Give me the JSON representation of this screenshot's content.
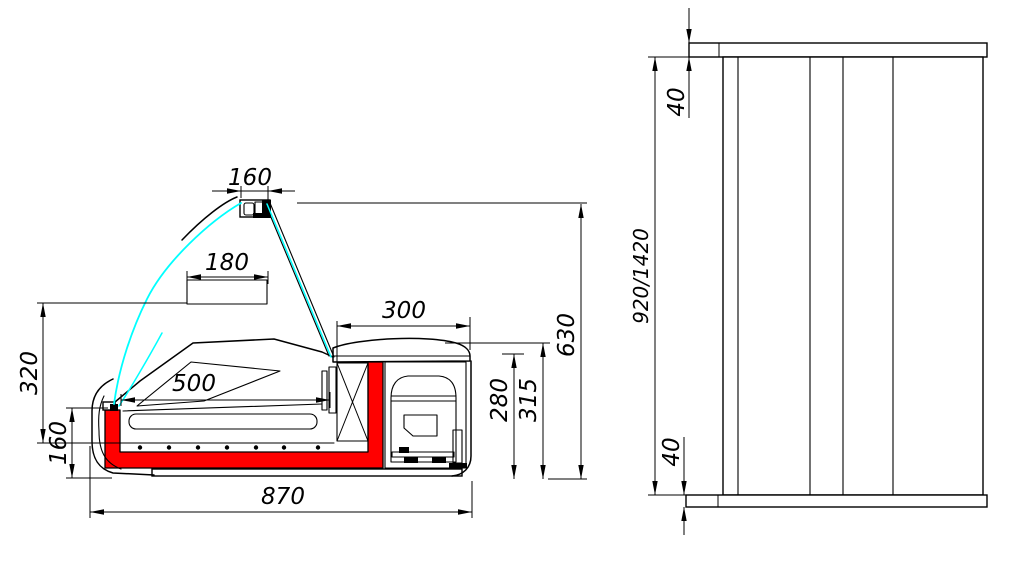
{
  "drawing": {
    "units": "mm",
    "colors": {
      "outline": "#000000",
      "insulation": "#ff0000",
      "glass": "#00ffff",
      "background": "#ffffff"
    },
    "side": {
      "dims": {
        "canopy_width": "160",
        "shelf_width": "180",
        "deck_length": "500",
        "machine_top_width": "300",
        "front_upper_height": "320",
        "front_lower_height": "160",
        "overall_depth": "870",
        "overall_height": "630",
        "machine_height": "315",
        "opening_height": "280"
      }
    },
    "front": {
      "dims": {
        "top_panel": "40",
        "bottom_panel": "40",
        "body_height": "920/1420"
      }
    }
  }
}
